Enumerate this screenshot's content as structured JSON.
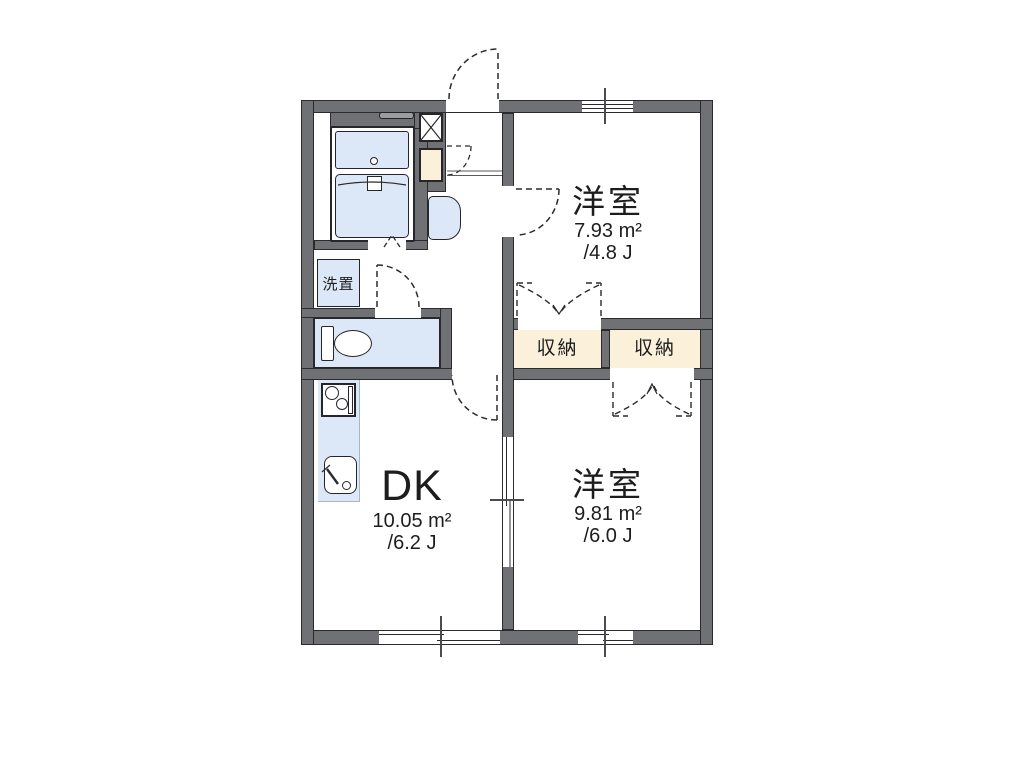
{
  "plan": {
    "type": "apartment-floor-plan",
    "labels": {
      "room_top": {
        "name": "洋室",
        "area": "7.93 m²",
        "tatami": "/4.8 J"
      },
      "room_dk": {
        "name": "DK",
        "area": "10.05 m²",
        "tatami": "/6.2 J"
      },
      "room_bottom": {
        "name": "洋室",
        "area": "9.81 m²",
        "tatami": "/6.0 J"
      },
      "closet_left": "収納",
      "closet_right": "収納",
      "laundry": "洗置"
    },
    "colors": {
      "wall": "#6f7175",
      "outline": "#2b2b2e",
      "fixture_fill": "#dce8f7",
      "closet_fill": "#fbf0da",
      "background": "#ffffff"
    }
  }
}
